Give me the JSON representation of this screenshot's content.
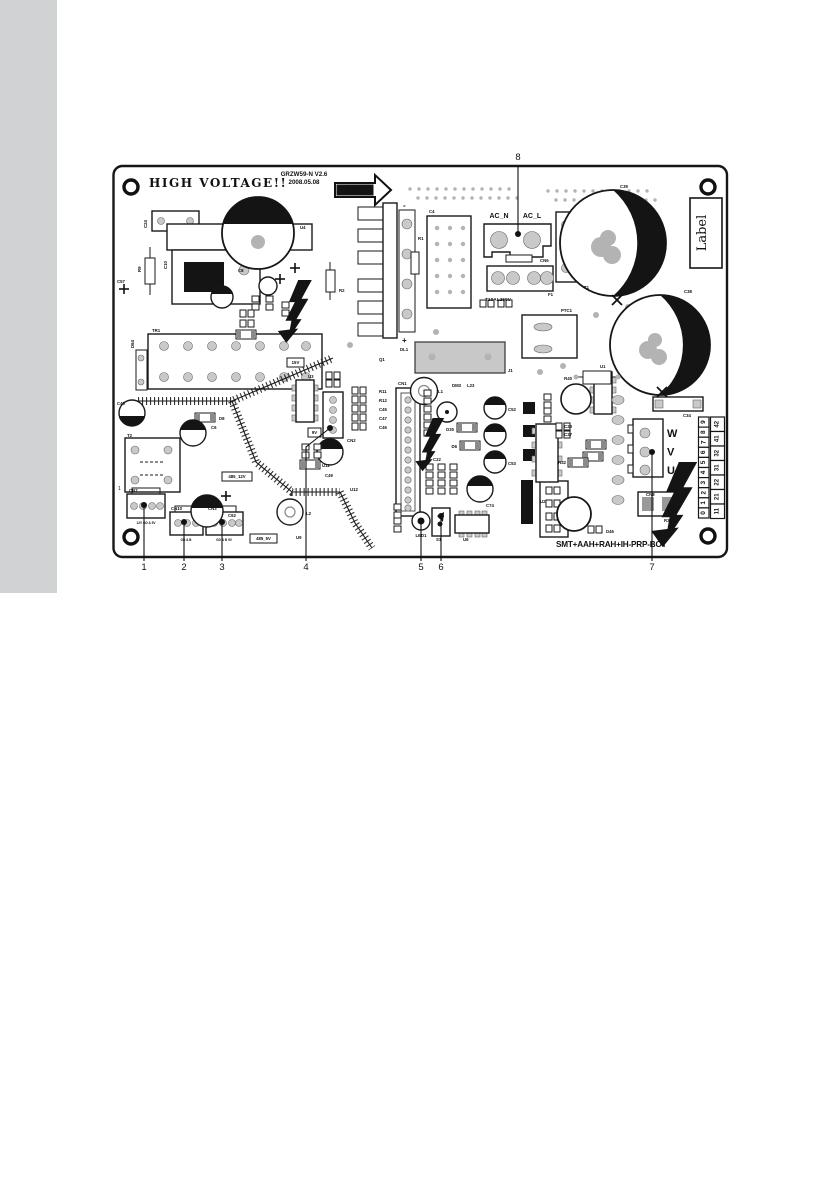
{
  "page": {
    "bg": "#ffffff",
    "sidebar_color": "#d0d2d4"
  },
  "board": {
    "title": "HIGH VOLTAGE!!",
    "version": "GRZW59-N V2.6",
    "date": "2008.05.08",
    "sol_label": "SOL",
    "ac_n": "AC_N",
    "ac_l": "AC_L",
    "fuse_rating": "T10AL250V",
    "label_box": "Label",
    "bottom_code": "SMT+AAH+RAH+IH-PRP-BOT",
    "heatsink_minus": "-",
    "heatsink_plus": "+",
    "t2_pin1": "1",
    "phase_labels": [
      "W",
      "V",
      "U"
    ],
    "terminal_inner": [
      "9",
      "8",
      "7",
      "6",
      "5",
      "4",
      "3",
      "2",
      "1",
      "0"
    ],
    "terminal_outer": [
      "42",
      "41",
      "32",
      "31",
      "22",
      "21",
      "11"
    ],
    "boxed_labels": [
      {
        "t": "485_12V",
        "x": 222,
        "y": 472,
        "w": 30,
        "h": 9
      },
      {
        "t": "485_5V",
        "x": 250,
        "y": 534,
        "w": 27,
        "h": 9
      },
      {
        "t": "15V",
        "x": 287,
        "y": 358,
        "w": 17,
        "h": 9
      },
      {
        "t": "9V",
        "x": 308,
        "y": 428,
        "w": 13,
        "h": 9
      }
    ],
    "pin_labels": [
      {
        "t": "12V GD A 5V",
        "x": 146,
        "y": 524
      },
      {
        "t": "GD A B",
        "x": 186,
        "y": 541
      },
      {
        "t": "GD A B 5V",
        "x": 224,
        "y": 541
      }
    ],
    "labels": [
      {
        "t": "C24",
        "x": 147,
        "y": 228,
        "r": -90
      },
      {
        "t": "U4",
        "x": 300,
        "y": 229
      },
      {
        "t": "C10",
        "x": 167,
        "y": 269,
        "r": -90
      },
      {
        "t": "R9",
        "x": 141,
        "y": 272,
        "r": -90
      },
      {
        "t": "C57",
        "x": 117,
        "y": 283
      },
      {
        "t": "C8",
        "x": 238,
        "y": 272
      },
      {
        "t": "R2",
        "x": 339,
        "y": 292
      },
      {
        "t": "T1",
        "x": 584,
        "y": 289
      },
      {
        "t": "C4",
        "x": 429,
        "y": 213
      },
      {
        "t": "R1",
        "x": 418,
        "y": 240
      },
      {
        "t": "CN6",
        "x": 540,
        "y": 262
      },
      {
        "t": "F1",
        "x": 548,
        "y": 296
      },
      {
        "t": "C39",
        "x": 620,
        "y": 188
      },
      {
        "t": "C38",
        "x": 684,
        "y": 293
      },
      {
        "t": "PTC1",
        "x": 561,
        "y": 312
      },
      {
        "t": "J1",
        "x": 508,
        "y": 372
      },
      {
        "t": "R40",
        "x": 572,
        "y": 380,
        "a": "end"
      },
      {
        "t": "TR1",
        "x": 152,
        "y": 332
      },
      {
        "t": "D64",
        "x": 134,
        "y": 348,
        "r": -90
      },
      {
        "t": "C40",
        "x": 117,
        "y": 405
      },
      {
        "t": "D8",
        "x": 219,
        "y": 420
      },
      {
        "t": "C6",
        "x": 211,
        "y": 429
      },
      {
        "t": "T2",
        "x": 127,
        "y": 437
      },
      {
        "t": "C62",
        "x": 228,
        "y": 517
      },
      {
        "t": "L2",
        "x": 306,
        "y": 515
      },
      {
        "t": "CN7",
        "x": 129,
        "y": 492
      },
      {
        "t": "CN10",
        "x": 171,
        "y": 510
      },
      {
        "t": "CN3",
        "x": 208,
        "y": 510
      },
      {
        "t": "U3",
        "x": 308,
        "y": 378
      },
      {
        "t": "CN2",
        "x": 347,
        "y": 442
      },
      {
        "t": "U1",
        "x": 600,
        "y": 368
      },
      {
        "t": "U2",
        "x": 540,
        "y": 503
      },
      {
        "t": "CN1",
        "x": 398,
        "y": 385
      },
      {
        "t": "L1",
        "x": 438,
        "y": 393
      },
      {
        "t": "DM3",
        "x": 452,
        "y": 387
      },
      {
        "t": "L23",
        "x": 467,
        "y": 387
      },
      {
        "t": "D30",
        "x": 454,
        "y": 431,
        "a": "end"
      },
      {
        "t": "D6",
        "x": 457,
        "y": 448,
        "a": "end"
      },
      {
        "t": "C22",
        "x": 433,
        "y": 461
      },
      {
        "t": "C52",
        "x": 508,
        "y": 411
      },
      {
        "t": "C53",
        "x": 508,
        "y": 465
      },
      {
        "t": "C49",
        "x": 329,
        "y": 477,
        "a": "middle"
      },
      {
        "t": "C74",
        "x": 486,
        "y": 507
      },
      {
        "t": "LED1",
        "x": 421,
        "y": 537,
        "a": "middle"
      },
      {
        "t": "S1",
        "x": 436,
        "y": 541
      },
      {
        "t": "U6",
        "x": 463,
        "y": 541
      },
      {
        "t": "C34",
        "x": 683,
        "y": 417
      },
      {
        "t": "R35",
        "x": 664,
        "y": 522
      },
      {
        "t": "CN8",
        "x": 646,
        "y": 496
      },
      {
        "t": "D46",
        "x": 606,
        "y": 533
      },
      {
        "t": "C23",
        "x": 572,
        "y": 428,
        "a": "end"
      },
      {
        "t": "C27",
        "x": 572,
        "y": 436,
        "a": "end"
      },
      {
        "t": "R32",
        "x": 566,
        "y": 464,
        "a": "end"
      },
      {
        "t": "R11",
        "x": 379,
        "y": 393
      },
      {
        "t": "R12",
        "x": 379,
        "y": 402
      },
      {
        "t": "C45",
        "x": 379,
        "y": 411
      },
      {
        "t": "C47",
        "x": 379,
        "y": 420
      },
      {
        "t": "C46",
        "x": 379,
        "y": 429
      },
      {
        "t": "U11",
        "x": 322,
        "y": 467
      },
      {
        "t": "U12",
        "x": 350,
        "y": 491
      },
      {
        "t": "DL1",
        "x": 400,
        "y": 351
      },
      {
        "t": "Q1",
        "x": 379,
        "y": 361
      },
      {
        "t": "U9",
        "x": 296,
        "y": 539
      }
    ]
  },
  "callouts": [
    {
      "n": "1",
      "dot": [
        144,
        505
      ],
      "pts": [
        [
          144,
          505
        ],
        [
          144,
          561
        ]
      ],
      "lab": [
        144,
        570
      ]
    },
    {
      "n": "2",
      "dot": [
        184,
        522
      ],
      "pts": [
        [
          184,
          522
        ],
        [
          184,
          561
        ]
      ],
      "lab": [
        184,
        570
      ]
    },
    {
      "n": "3",
      "dot": [
        222,
        522
      ],
      "pts": [
        [
          222,
          522
        ],
        [
          222,
          561
        ]
      ],
      "lab": [
        222,
        570
      ]
    },
    {
      "n": "4",
      "dot": [
        330,
        428
      ],
      "pts": [
        [
          330,
          428
        ],
        [
          306,
          447
        ],
        [
          306,
          561
        ]
      ],
      "lab": [
        306,
        570
      ]
    },
    {
      "n": "5",
      "dot": [
        421,
        521
      ],
      "pts": [
        [
          421,
          521
        ],
        [
          421,
          561
        ]
      ],
      "lab": [
        421,
        570
      ]
    },
    {
      "n": "6",
      "dot": [
        441,
        516
      ],
      "pts": [
        [
          441,
          516
        ],
        [
          441,
          561
        ]
      ],
      "lab": [
        441,
        570
      ]
    },
    {
      "n": "7",
      "dot": [
        652,
        452
      ],
      "pts": [
        [
          652,
          452
        ],
        [
          652,
          561
        ]
      ],
      "lab": [
        652,
        570
      ]
    },
    {
      "n": "8",
      "dot": [
        518,
        234
      ],
      "pts": [
        [
          518,
          234
        ],
        [
          518,
          166
        ]
      ],
      "lab": [
        518,
        160
      ]
    }
  ]
}
